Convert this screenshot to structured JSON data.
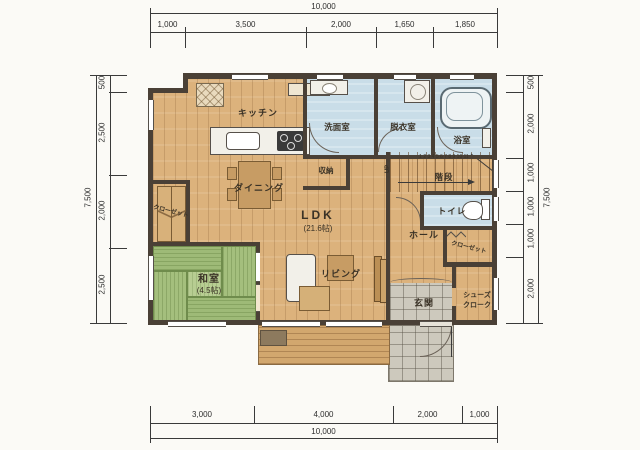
{
  "plan": {
    "rooms": {
      "kitchen": {
        "label": "キッチン"
      },
      "washroom": {
        "label": "洗面室"
      },
      "dressing_room": {
        "label": "脱衣室"
      },
      "bathroom": {
        "label": "浴室"
      },
      "storage": {
        "label": "収納"
      },
      "stairs": {
        "label": "階段",
        "step_numbers": "1 2 3 4 5 6 7 8 9 10 11",
        "up": "UP"
      },
      "dining": {
        "label": "ダイニング"
      },
      "ldk": {
        "label": "LDK",
        "size": "(21.6帖)"
      },
      "toilet": {
        "label": "トイレ"
      },
      "hall": {
        "label": "ホール"
      },
      "closet_left": {
        "label": "クローゼット"
      },
      "closet_hall": {
        "label": "クローゼット"
      },
      "japanese_room": {
        "label": "和室",
        "size": "(4.5帖)"
      },
      "living": {
        "label": "リビング"
      },
      "entrance": {
        "label": "玄関"
      },
      "shoe_closet": {
        "line1": "シューズ",
        "line2": "クローク"
      }
    }
  },
  "dimensions": {
    "top": {
      "total": "10,000",
      "segments": [
        "1,000",
        "3,500",
        "2,000",
        "1,650",
        "1,850"
      ]
    },
    "bottom": {
      "total": "10,000",
      "segments": [
        "3,000",
        "4,000",
        "2,000",
        "1,000"
      ]
    },
    "left": {
      "total": "7,500",
      "segments": [
        "500",
        "2,500",
        "2,000",
        "2,500"
      ]
    },
    "right": {
      "total": "7,500",
      "segments": [
        "500",
        "2,000",
        "1,000",
        "1,000",
        "1,000",
        "2,000"
      ]
    }
  },
  "colors": {
    "wall": "#4a4036",
    "wood_floor": "#dcb27c",
    "tatami": "#a4bf7d",
    "wet_floor": "#c9dde8",
    "tile": "#cdc9bd"
  }
}
